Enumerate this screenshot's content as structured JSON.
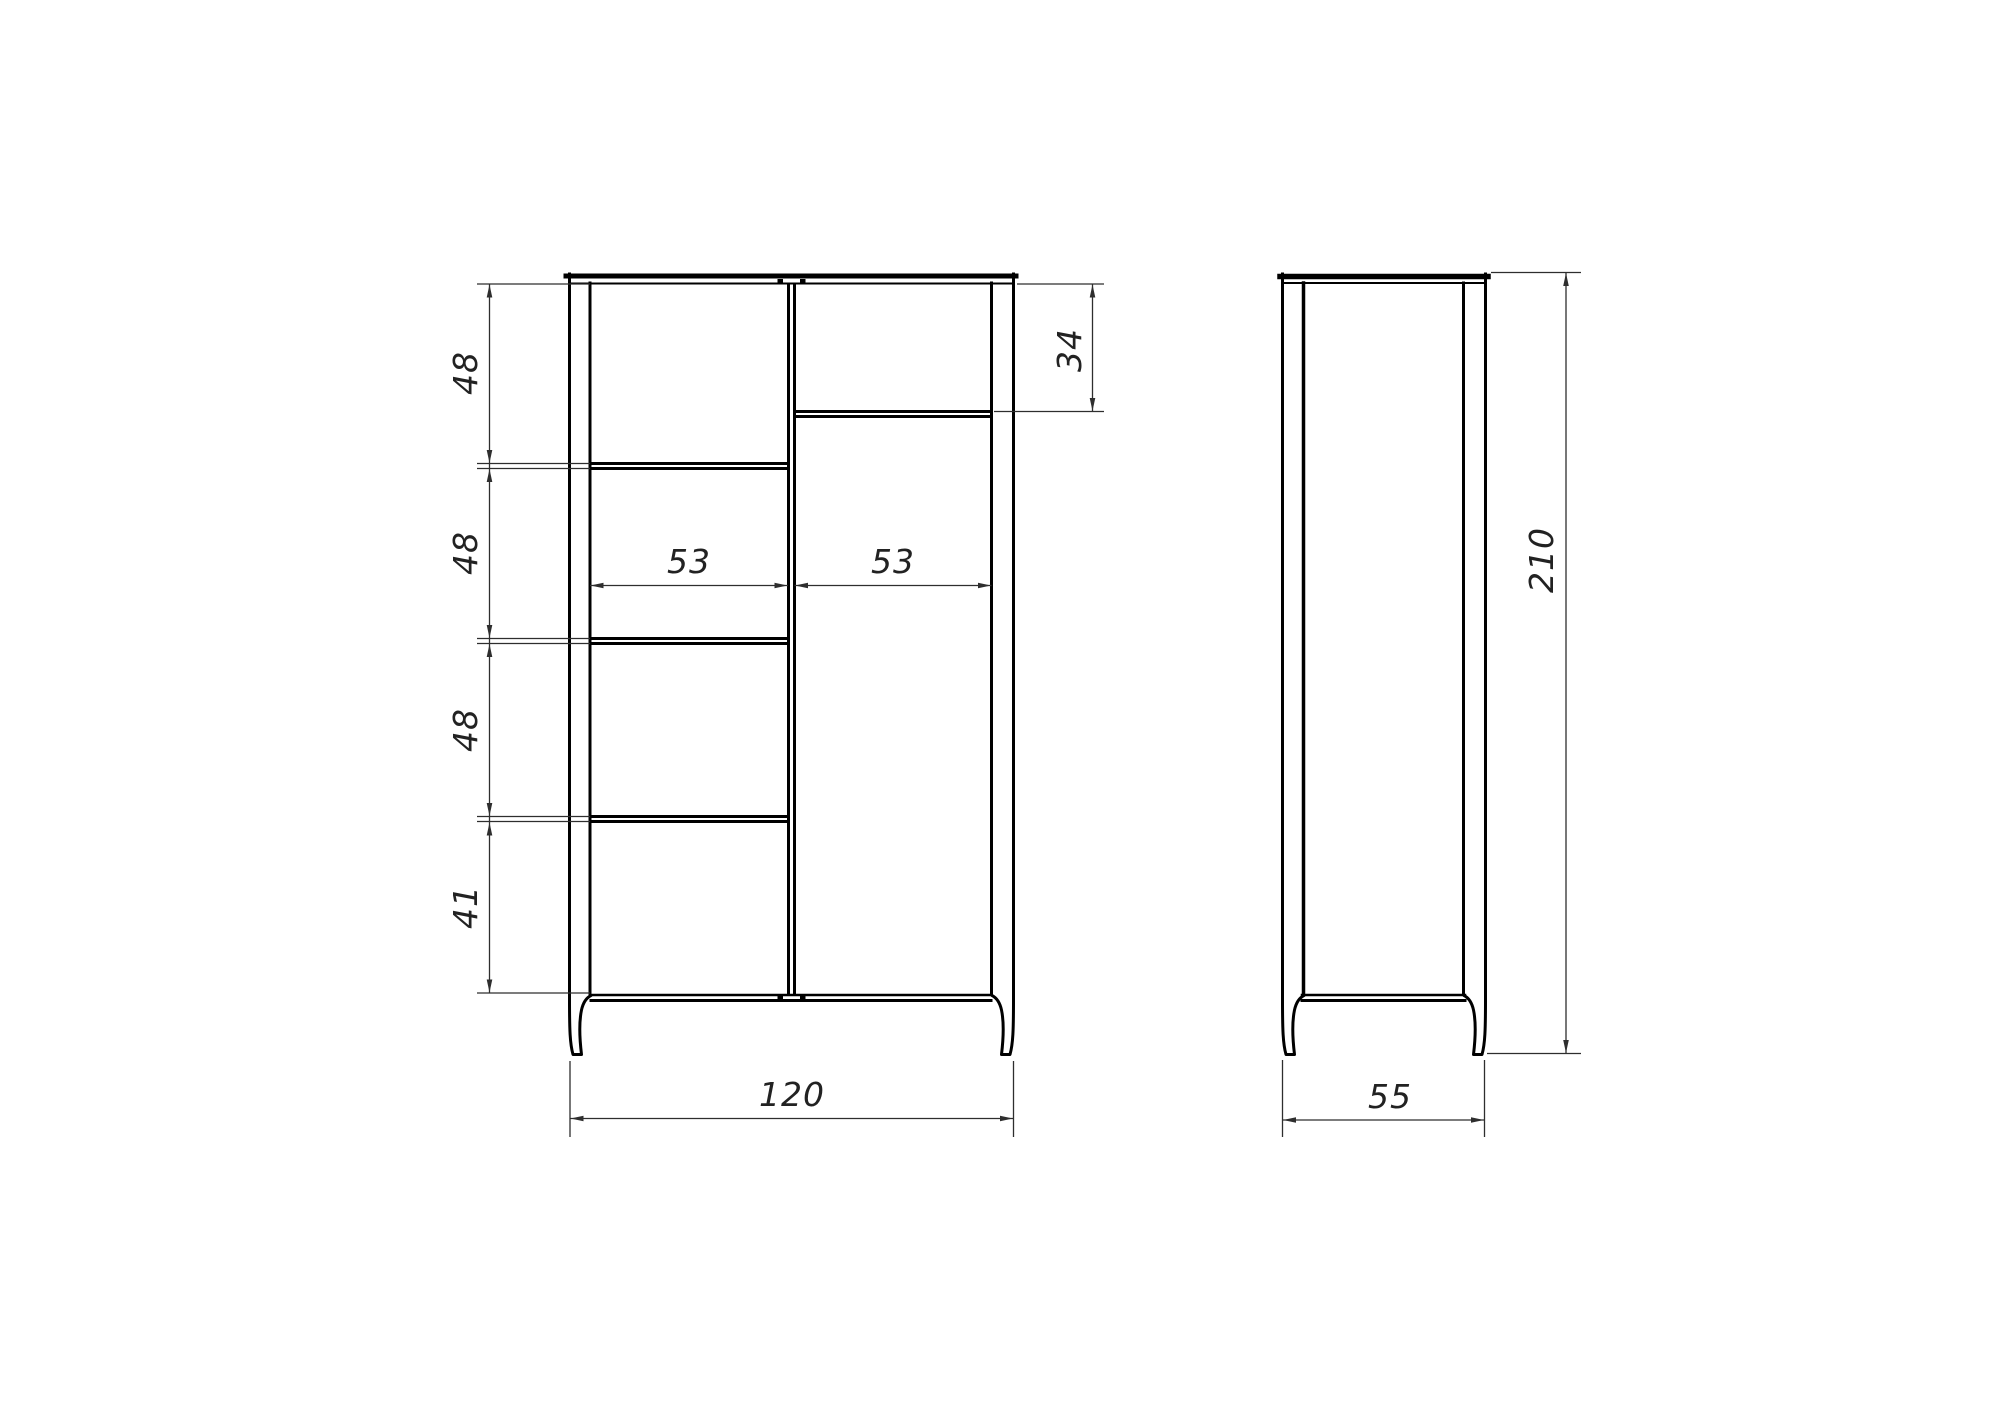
{
  "dimensions": {
    "height_segments": [
      "48",
      "48",
      "48",
      "41"
    ],
    "upper_right_shelf_height": "34",
    "compartment_widths": [
      "53",
      "53"
    ],
    "overall_width": "120",
    "overall_depth": "55",
    "overall_height": "210"
  },
  "colors": {
    "structure": "#000000",
    "dimension": "#2e2e2e",
    "text": "#222222",
    "background": "#ffffff"
  }
}
